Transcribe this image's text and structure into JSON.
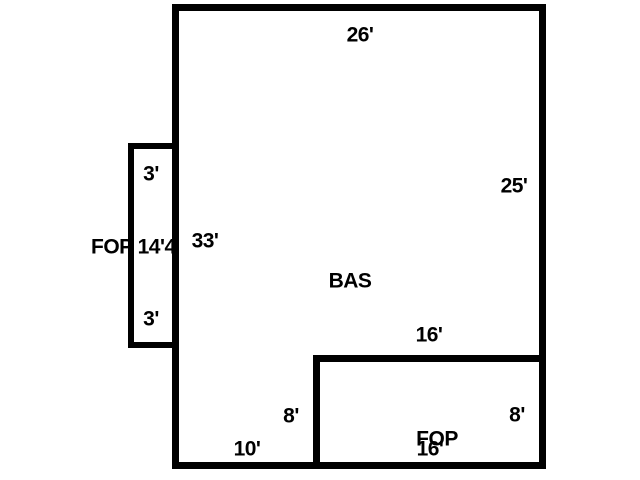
{
  "diagram": {
    "type": "floor-plan-sketch",
    "colors": {
      "background": "#ffffff",
      "line": "#000000",
      "text": "#000000"
    },
    "areas": [
      {
        "id": "bas",
        "label": "BAS"
      },
      {
        "id": "fop-left-porch",
        "label": "FOP 14'4"
      },
      {
        "id": "fop-bottom",
        "label": "FOP"
      }
    ],
    "dimensions": {
      "main_top": "26'",
      "main_right": "25'",
      "main_left": "33'",
      "porch_top": "3'",
      "porch_bottom": "3'",
      "fop_top": "16'",
      "fop_left": "8'",
      "fop_right": "8'",
      "main_bottom_left": "10'",
      "fop_bottom": "16'"
    }
  }
}
